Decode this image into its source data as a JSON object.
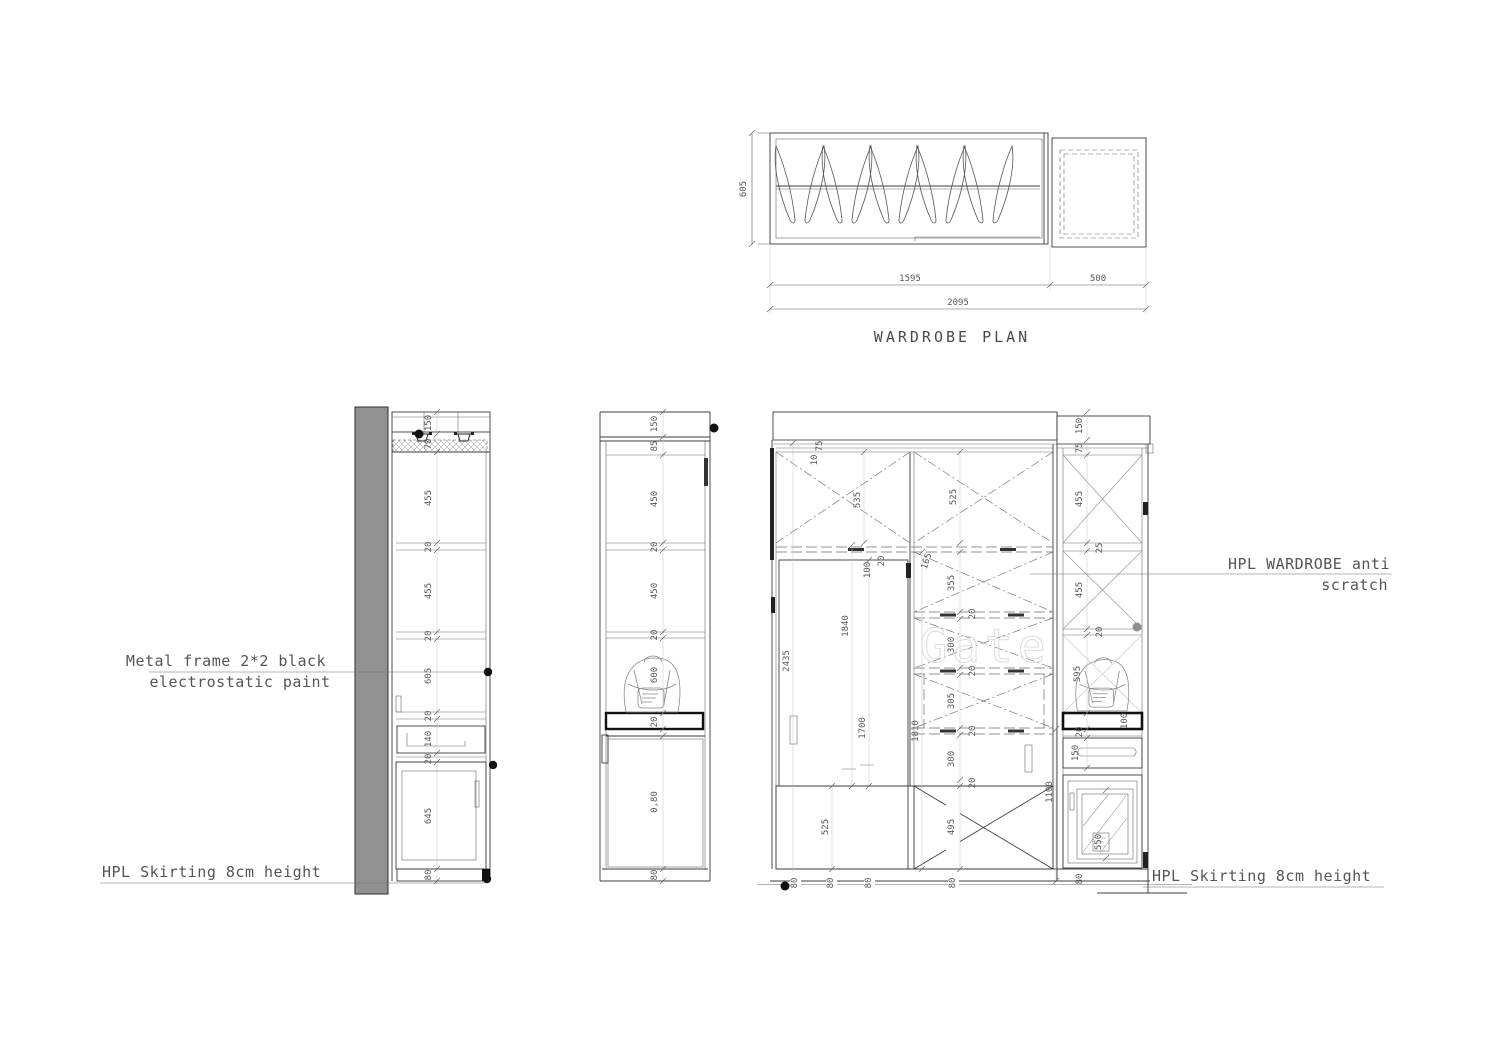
{
  "plan": {
    "title": "WARDROBE PLAN",
    "depth": "605",
    "w_left": "1595",
    "w_right": "500",
    "w_total": "2095"
  },
  "left_elevation": {
    "dims": [
      "150",
      "70",
      "455",
      "20",
      "455",
      "20",
      "605",
      "20",
      "140",
      "20",
      "645",
      "80"
    ]
  },
  "middle_elevation": {
    "dims": [
      "150",
      "85",
      "450",
      "20",
      "450",
      "20",
      "600",
      "20",
      "0,80",
      "80"
    ]
  },
  "front_elevation": {
    "top10": "10",
    "top75": "75",
    "p535": "535",
    "p525": "525",
    "r20": "20",
    "r100": "100",
    "r165": "165",
    "stack": [
      "355",
      "20",
      "300",
      "20",
      "305",
      "20",
      "300",
      "20"
    ],
    "x495": "495",
    "slat525": "525",
    "h2435": "2435",
    "h1840": "1840",
    "h1700": "1700",
    "h1810": "1810",
    "h1100": "1100",
    "col": [
      "150",
      "75",
      "455",
      "25",
      "455",
      "20",
      "595",
      "100",
      "20",
      "150",
      "550"
    ],
    "sk": [
      "80",
      "80",
      "80",
      "80",
      "80"
    ]
  },
  "labels": {
    "metal1": "Metal frame 2*2 black",
    "metal2": "electrostatic paint",
    "hpl1": "HPL WARDROBE anti",
    "hpl2": "scratch",
    "sk_left": "HPL Skirting 8cm height",
    "sk_right": "HPL Skirting 8cm height"
  },
  "watermark": "Gate",
  "colors": {
    "wall": "#919191",
    "line": "#3c3c3c",
    "dim_text": "#585858"
  }
}
